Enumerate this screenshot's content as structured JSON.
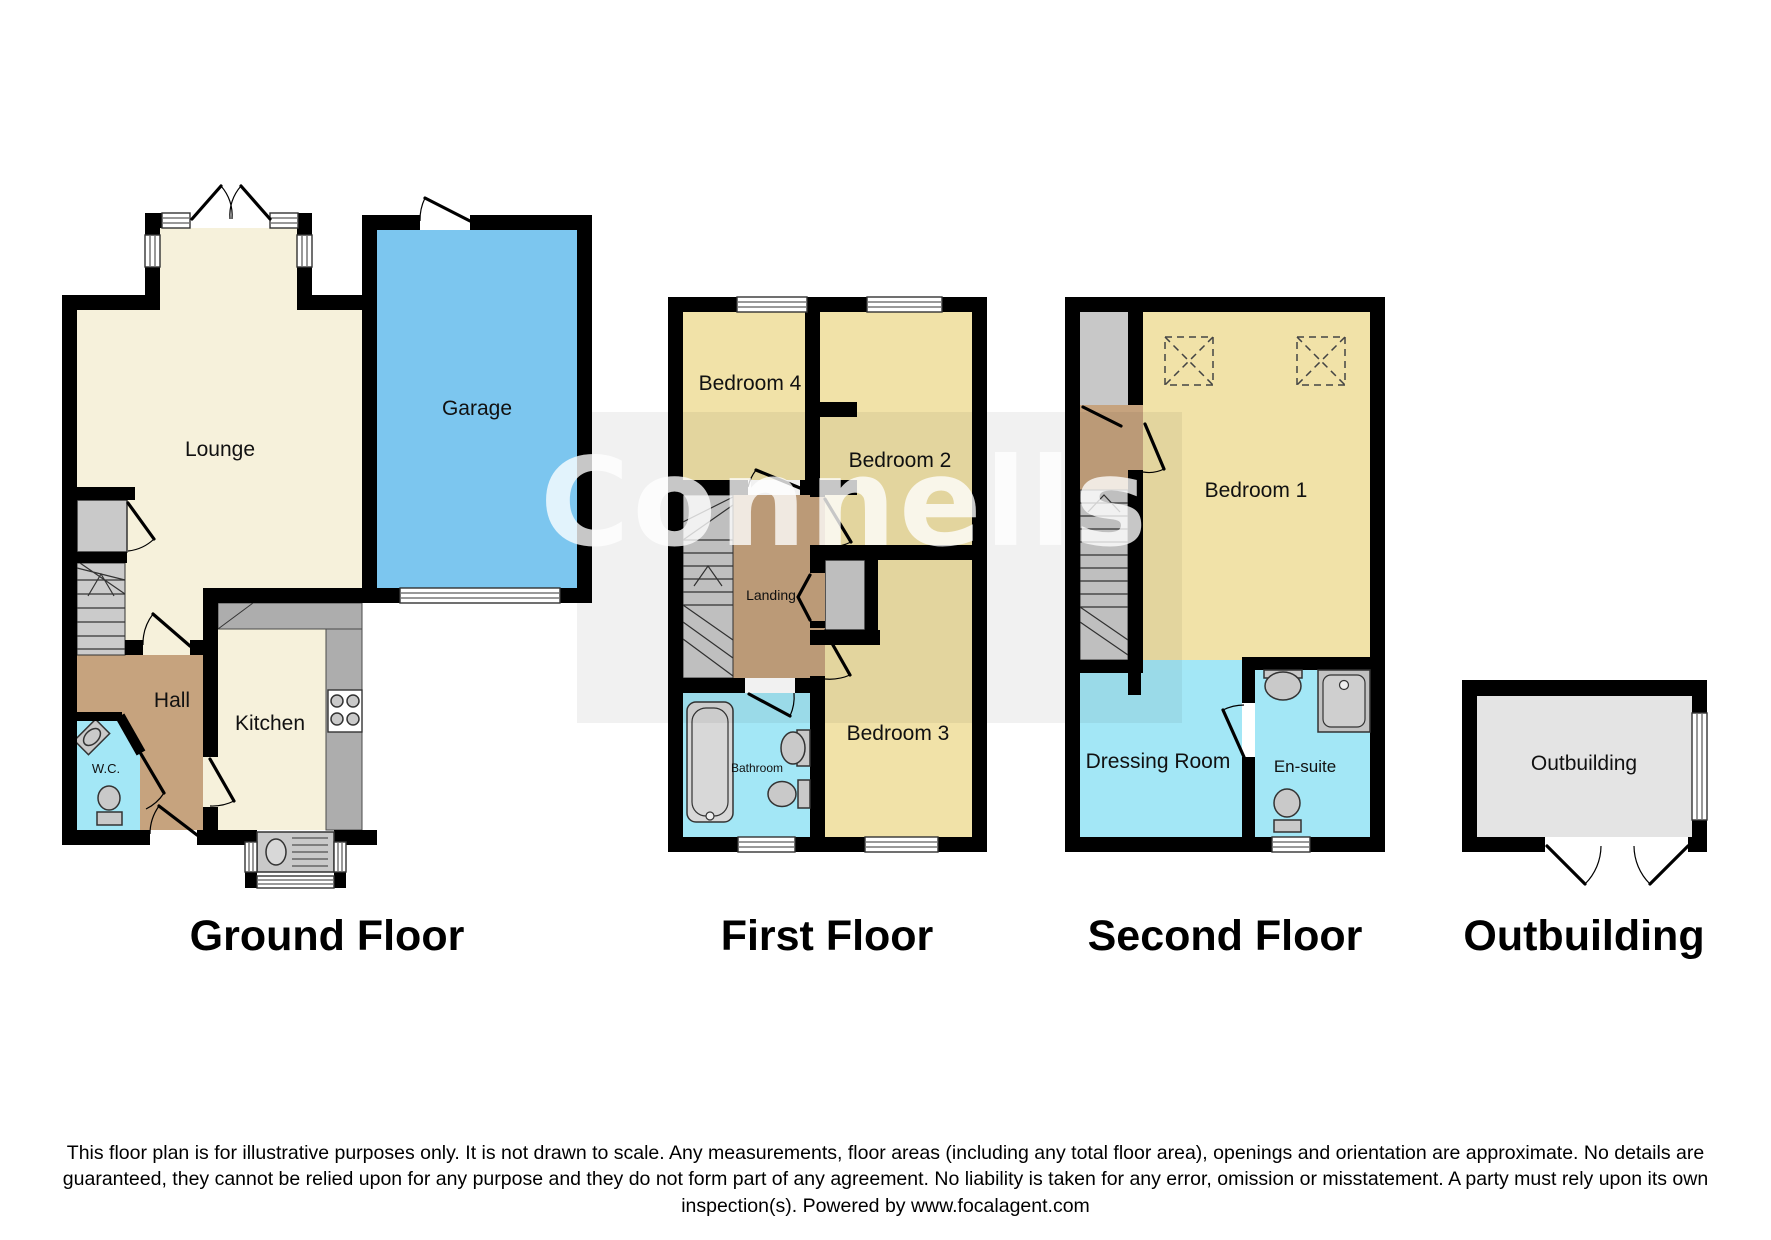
{
  "watermark": {
    "brand": "Connells"
  },
  "floors": {
    "ground": {
      "title": "Ground Floor",
      "rooms": {
        "lounge": "Lounge",
        "garage": "Garage",
        "hall": "Hall",
        "kitchen": "Kitchen",
        "wc": "W.C."
      }
    },
    "first": {
      "title": "First Floor",
      "rooms": {
        "bedroom4": "Bedroom 4",
        "bedroom2": "Bedroom 2",
        "landing": "Landing",
        "bathroom": "Bathroom",
        "bedroom3": "Bedroom 3"
      }
    },
    "second": {
      "title": "Second Floor",
      "rooms": {
        "bedroom1": "Bedroom 1",
        "dressing_room": "Dressing Room",
        "ensuite": "En-suite"
      }
    },
    "outbuilding": {
      "title": "Outbuilding",
      "rooms": {
        "outbuilding": "Outbuilding"
      }
    }
  },
  "footer": {
    "disclaimer": "This floor plan is for illustrative purposes only. It is not drawn to scale. Any measurements, floor areas (including any total floor area), openings and orientation are approximate. No details are guaranteed, they cannot be relied upon for any purpose and they do not form part of any agreement. No liability is taken for any error, omission or misstatement. A party must rely upon its own inspection(s). Powered by www.focalagent.com"
  },
  "colors": {
    "wall": "#000000",
    "cream_room": "#F6F1DB",
    "yellow_room": "#F1E2A8",
    "tan_room": "#C6A37E",
    "cyan_room": "#A3E7F6",
    "garage_blue": "#7CC6EF",
    "fixture_grey": "#C9C9C9",
    "counter_grey": "#ADADAD",
    "outbuilding_grey": "#E4E4E4"
  }
}
